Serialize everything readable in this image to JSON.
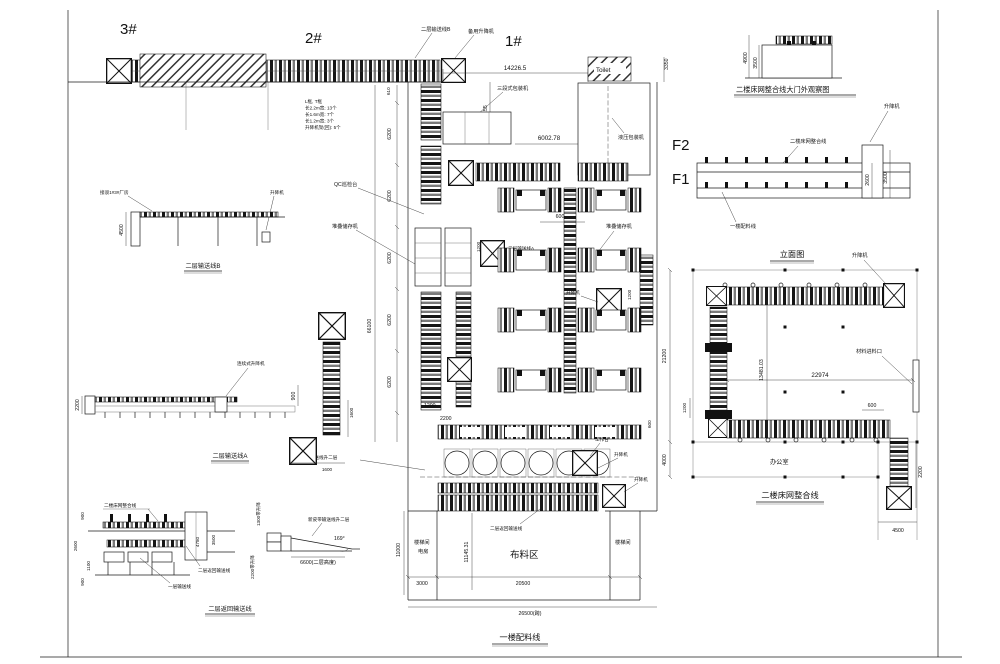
{
  "page": {
    "bg": "#ffffff",
    "ink": "#1a1a1a"
  },
  "top_line": {
    "mark_3": "3#",
    "mark_2": "2#",
    "mark_1": "1#",
    "label_level2_conveyor_b": "二层输送线B",
    "label_spare_lift": "备用升降机",
    "note": {
      "l1": "L框, T框",
      "l2": "长2.2m宽: 13个",
      "l3": "长1.6m宽: 7个",
      "l4": "长1.2m宽: 3个",
      "l5": "升降机架(回): 5个"
    },
    "dims": {
      "d610": "610"
    }
  },
  "main_plan": {
    "title": "一楼配料线",
    "labels": {
      "three_stage_packer": "三段式包装机",
      "toilet": "Toilet",
      "hydraulic_packer": "液压包装机",
      "qc_station": "QC巡检台",
      "stacker_left": "堆叠储存机",
      "stacker_right": "堆叠储存机",
      "line2a": "二层输送线A",
      "lift_mid": "升降机",
      "workbench": "工作台",
      "lift_a": "升降机",
      "lift_b": "升降机",
      "new_belt_ramp": "新皮带输送线升二层",
      "return_line": "二层返回输送线",
      "stair_left": "楼梯间",
      "power_room": "电房",
      "fabric_zone": "布料区",
      "stair_right": "楼梯间"
    },
    "dims": {
      "d14226": "14226.5",
      "d7249": "7249.55",
      "d6002": "6002.78",
      "d3350": "3350",
      "chain": [
        "6200",
        "6200",
        "6200",
        "6200",
        "6200"
      ],
      "overall": "66100",
      "d600_top": "600",
      "d1200_a": "1200",
      "d1200_mid": "1200",
      "d600_right": "600",
      "d2200": "2200",
      "d1200_b": "1200",
      "d1600_v": "1600",
      "d1600_h": "1600",
      "d11000": "11000",
      "d11145": "11145.31",
      "d3000": "3000",
      "d20500": "20500",
      "d26500": "26500(跨)"
    },
    "floor_marks": {
      "f2": "F2",
      "f1": "F1"
    }
  },
  "gate_view": {
    "title": "二楼床网整合线大门外观察图",
    "labels": {
      "lift": "升降机"
    },
    "dims": {
      "d4900": "4900",
      "d3500": "3500"
    }
  },
  "elevation": {
    "title": "立面图",
    "labels": {
      "line2": "二楼床网整合线",
      "line1": "一楼配料线",
      "lift": "升降机"
    },
    "dims": {
      "d2600": "2600",
      "d3500": "3500"
    }
  },
  "u_plan": {
    "title": "二楼床网整合线",
    "labels": {
      "lift": "升降机",
      "material_inlet": "材料进料口",
      "office": "办公室"
    },
    "dims": {
      "d21200": "21200",
      "d13481": "13481.03",
      "d22974": "22974",
      "d600": "600",
      "d1200": "1200",
      "d4000": "4000",
      "d2200": "2200",
      "d4500": "4500"
    }
  },
  "detail_b": {
    "title": "二层输送线B",
    "labels": {
      "connect": "接驳1#3#厂房",
      "lift": "升降机"
    },
    "dims": {
      "d4500": "4500"
    }
  },
  "detail_a": {
    "title": "二层输送线A",
    "labels": {
      "cont_lift": "连续式升降机"
    },
    "dims": {
      "d2200": "2200",
      "d900": "900"
    }
  },
  "detail_return": {
    "title": "二层返回输送线",
    "labels": {
      "line2": "二楼床网整合线",
      "return_line": "二层返回输送线",
      "layer1": "一层输送线"
    },
    "dims": {
      "d900a": "900",
      "d2600": "2600",
      "d1100": "1100",
      "d900b": "900",
      "d4780": "4780",
      "d3500": "3500"
    }
  },
  "ramp": {
    "labels": {
      "belt": "新皮带输送线升二层",
      "v1300": "1300带升降",
      "v2200": "2200带升降"
    },
    "dims": {
      "angle": "169°",
      "d6600": "6600(二层高度)"
    }
  }
}
